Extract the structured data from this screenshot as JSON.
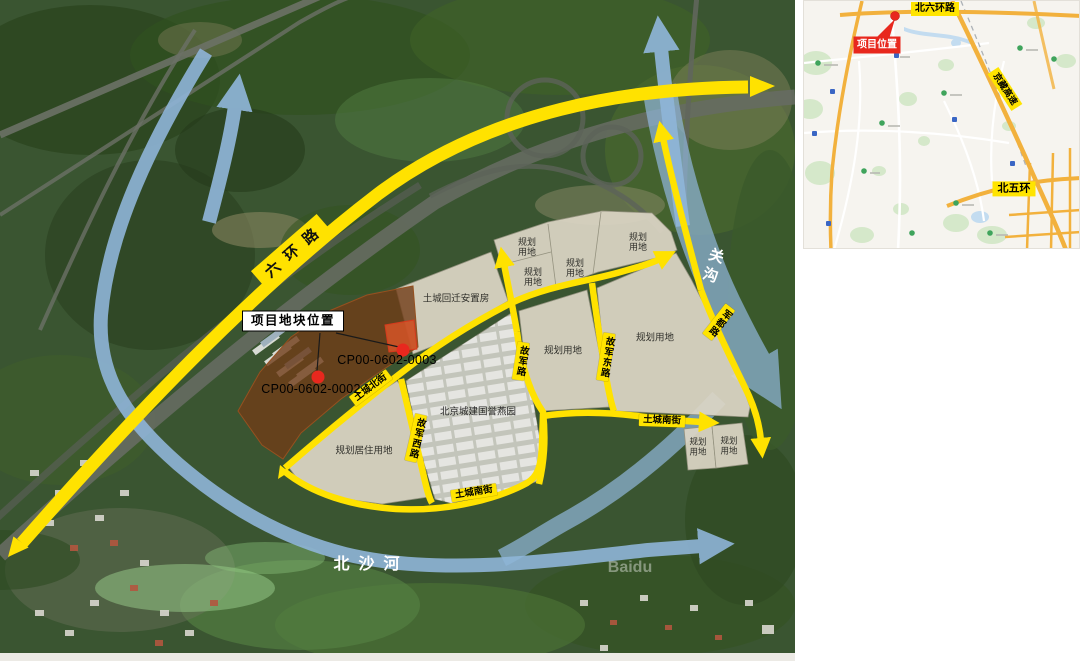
{
  "colors": {
    "road_yellow": "#ffe200",
    "label_yellow": "#ffe400",
    "river_blue": "#8fb5d8",
    "parcel_brown": "#703c18",
    "parcel_red": "#dd5528",
    "marker_red": "#e8281e",
    "planning_beige": "#dcd5c5"
  },
  "main_map": {
    "ring_road_label": "六环路",
    "rivers": {
      "guangou": "关沟",
      "beishahe": "北沙河"
    },
    "roads": {
      "tucheng_north": "土城北街",
      "tucheng_south": "土城南街",
      "gujun_west": "故军西路",
      "gujun": "故军路",
      "gujun_east": "故军东路",
      "jundu": "军都路"
    },
    "areas": {
      "planning": "规划用地",
      "planning_residential": "规划居住用地",
      "tucheng_resettlement": "土城回迁安置房",
      "guoyu_compound": "北京城建国誉燕园"
    },
    "project": {
      "callout": "项目地块位置",
      "parcel_a": "CP00-0602-0002",
      "parcel_b": "CP00-0602-0003"
    },
    "watermark": "Baidu"
  },
  "inset_map": {
    "labels": {
      "north_sixth_ring": "北六环路",
      "jingzang_expwy": "京藏高速",
      "north_fifth_ring": "北五环"
    },
    "project_badge": "项目位置"
  }
}
